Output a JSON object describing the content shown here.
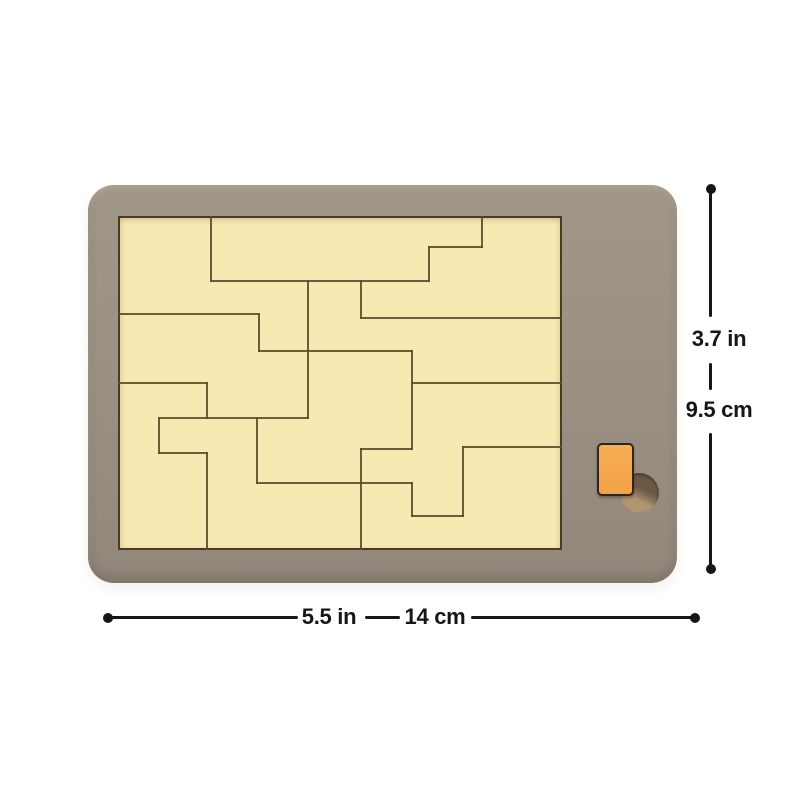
{
  "dimensions": {
    "height": {
      "inches": "3.7 in",
      "centimeters": "9.5 cm"
    },
    "width": {
      "inches": "5.5 in",
      "centimeters": "14 cm"
    }
  },
  "puzzle": {
    "board": {
      "shape": "rectangle",
      "fill": "#f8e8b2"
    },
    "segments": [
      [
        93,
        0,
        93,
        65
      ],
      [
        93,
        65,
        311,
        65
      ],
      [
        311,
        31,
        311,
        65
      ],
      [
        311,
        31,
        364,
        31
      ],
      [
        364,
        0,
        364,
        31
      ],
      [
        0,
        98,
        141,
        98
      ],
      [
        141,
        98,
        141,
        135
      ],
      [
        141,
        135,
        294,
        135
      ],
      [
        190,
        65,
        190,
        202
      ],
      [
        243,
        65,
        243,
        102
      ],
      [
        243,
        102,
        444,
        102
      ],
      [
        0,
        167,
        89,
        167
      ],
      [
        89,
        167,
        89,
        202
      ],
      [
        41,
        202,
        190,
        202
      ],
      [
        41,
        202,
        41,
        237
      ],
      [
        41,
        237,
        89,
        237
      ],
      [
        89,
        237,
        89,
        334
      ],
      [
        139,
        202,
        139,
        267
      ],
      [
        139,
        267,
        294,
        267
      ],
      [
        294,
        135,
        294,
        233
      ],
      [
        243,
        233,
        294,
        233
      ],
      [
        243,
        233,
        243,
        334
      ],
      [
        294,
        267,
        294,
        300
      ],
      [
        294,
        300,
        345,
        300
      ],
      [
        345,
        231,
        345,
        300
      ],
      [
        345,
        231,
        444,
        231
      ],
      [
        294,
        167,
        444,
        167
      ]
    ]
  },
  "colors": {
    "tray": "#9a9082",
    "board": "#f8e8b2",
    "piece_outline": "#5d4b2c",
    "board_outline": "#4a3b26",
    "accent_piece": "#f7a74c",
    "hole_dark": "#6b5944",
    "hole_light": "#b0957a",
    "annotation": "#161616",
    "background": "#ffffff"
  }
}
